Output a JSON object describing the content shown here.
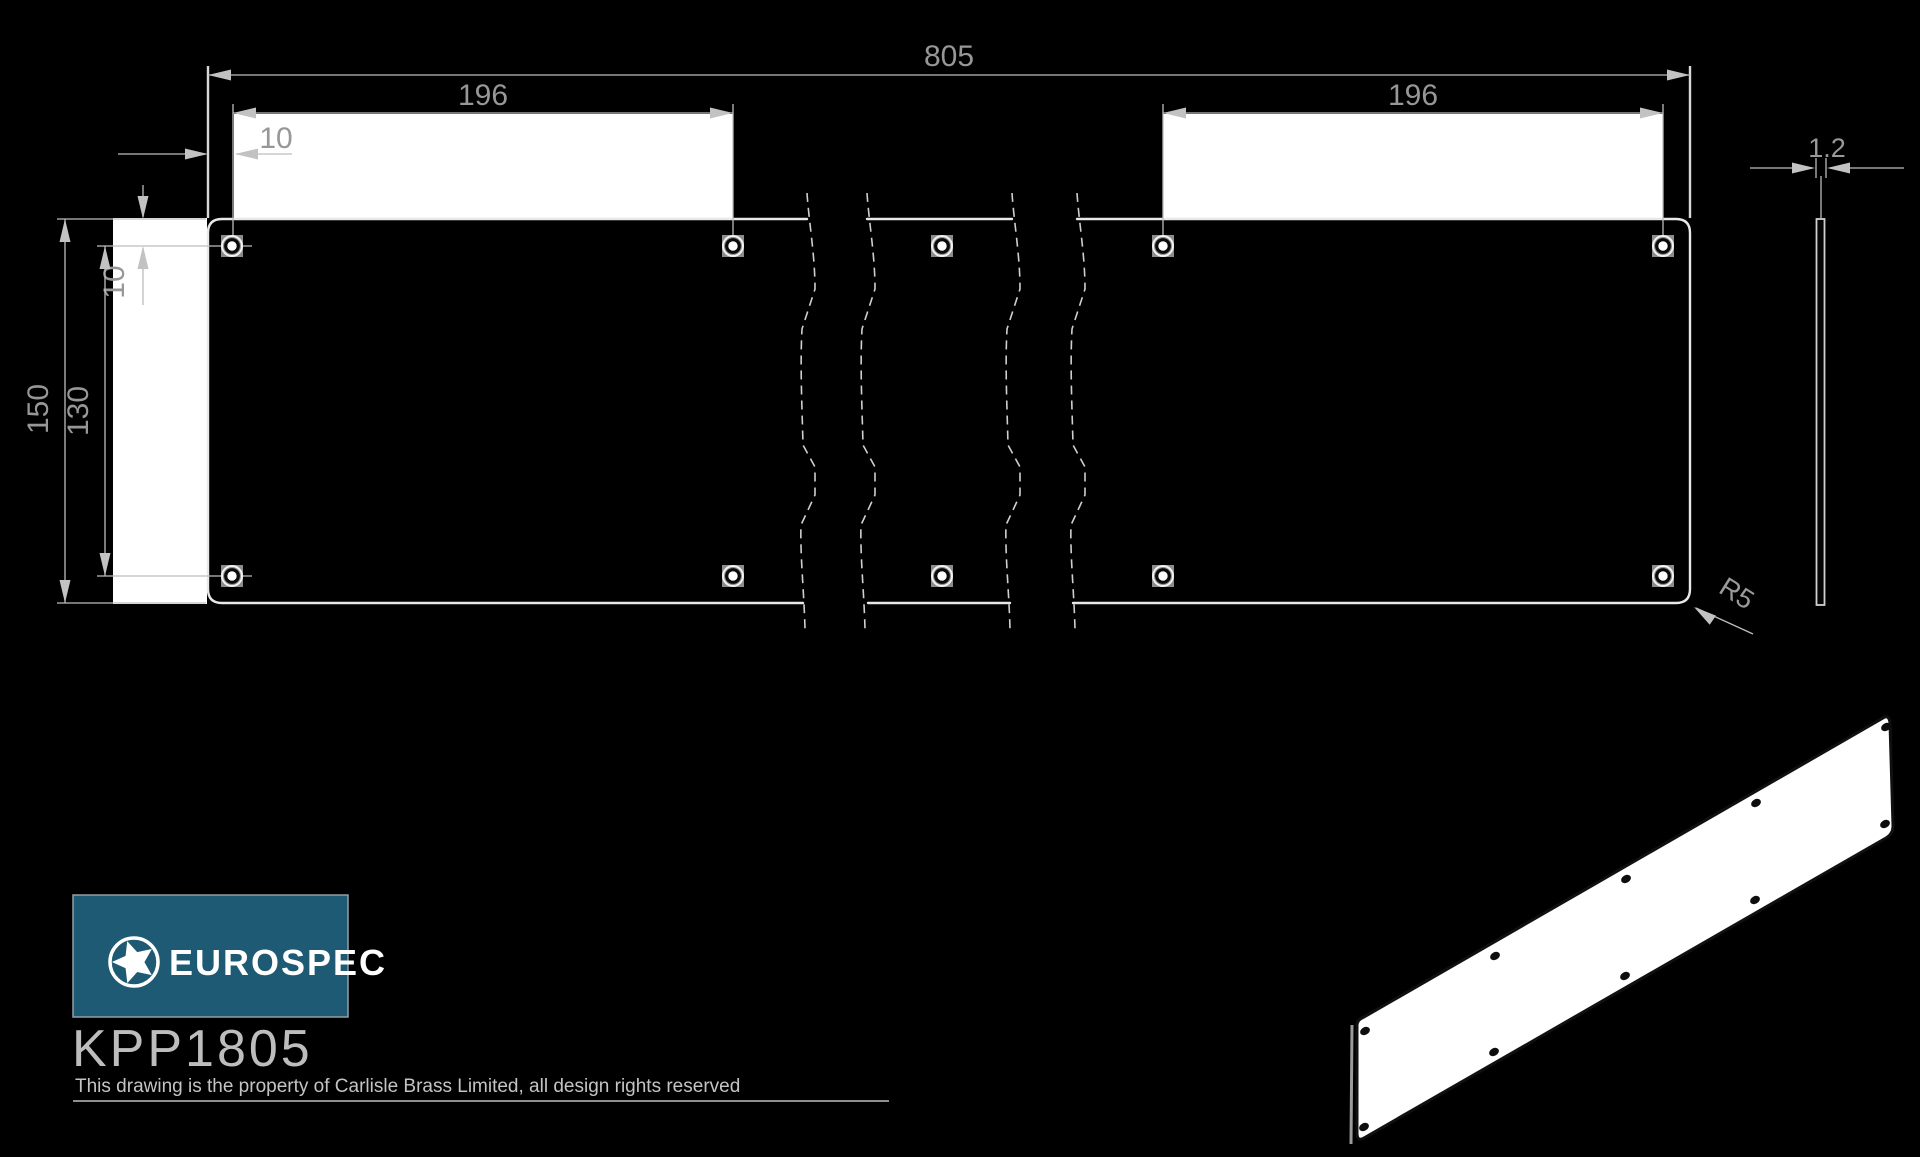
{
  "drawing": {
    "front_view": {
      "overall_width": "805",
      "panel_width_left": "196",
      "panel_width_right": "196",
      "hole_offset_x": "10",
      "hole_offset_y": "10",
      "overall_height": "150",
      "hole_spacing_vertical": "130",
      "corner_radius": "R5"
    },
    "side_view": {
      "thickness": "1.2"
    }
  },
  "title_block": {
    "brand": "EUROSPEC",
    "product_code": "KPP1805",
    "copyright": "This drawing is the property of Carlisle Brass Limited, all design rights reserved"
  },
  "colors": {
    "background": "#000000",
    "line": "#d8d8d8",
    "dimension_text": "#979797",
    "brand_panel": "#1e5a73",
    "brand_text": "#ffffff"
  }
}
